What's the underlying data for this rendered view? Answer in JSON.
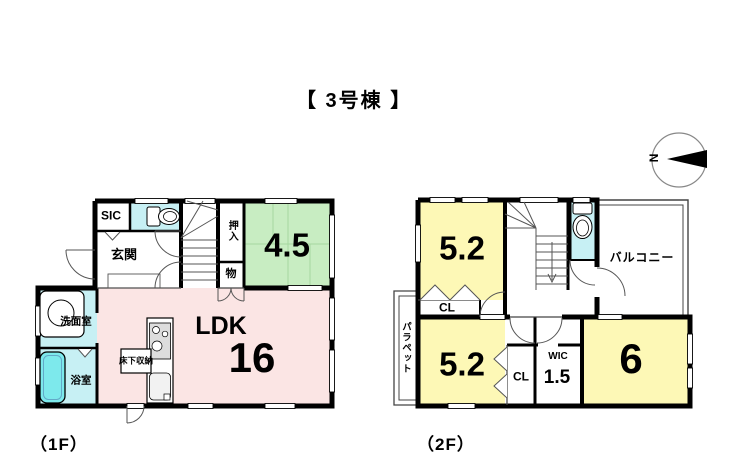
{
  "title": "【 3号棟 】",
  "compass": {
    "north_label": "N"
  },
  "floor1": {
    "caption": "（1F）",
    "rooms": {
      "sic": "SIC",
      "genkan": "玄関",
      "oshiire": "押入",
      "mono": "物",
      "tatami_size": "4.5",
      "ldk_name": "LDK",
      "ldk_size": "16",
      "senmenshitsu": "洗面室",
      "yokushitsu": "浴室",
      "yukashita_storage": "床下収納"
    }
  },
  "floor2": {
    "caption": "（2F）",
    "rooms": {
      "bedroom1_size": "5.2",
      "closet1": "CL",
      "balcony": "バルコニー",
      "parapet": "パラペット",
      "bedroom2_size": "5.2",
      "closet2": "CL",
      "wic_name": "WIC",
      "wic_size": "1.5",
      "bedroom3_size": "6"
    }
  },
  "colors": {
    "wall": "#000000",
    "ldk-pink": "#fbe5e4",
    "tatami-green": "#c8edc2",
    "room-yellow": "#fdf8b6",
    "water-cyan": "#c7f0f4",
    "tub-cyan": "#7de9ec",
    "tatami-line": "#a6d8a0"
  }
}
